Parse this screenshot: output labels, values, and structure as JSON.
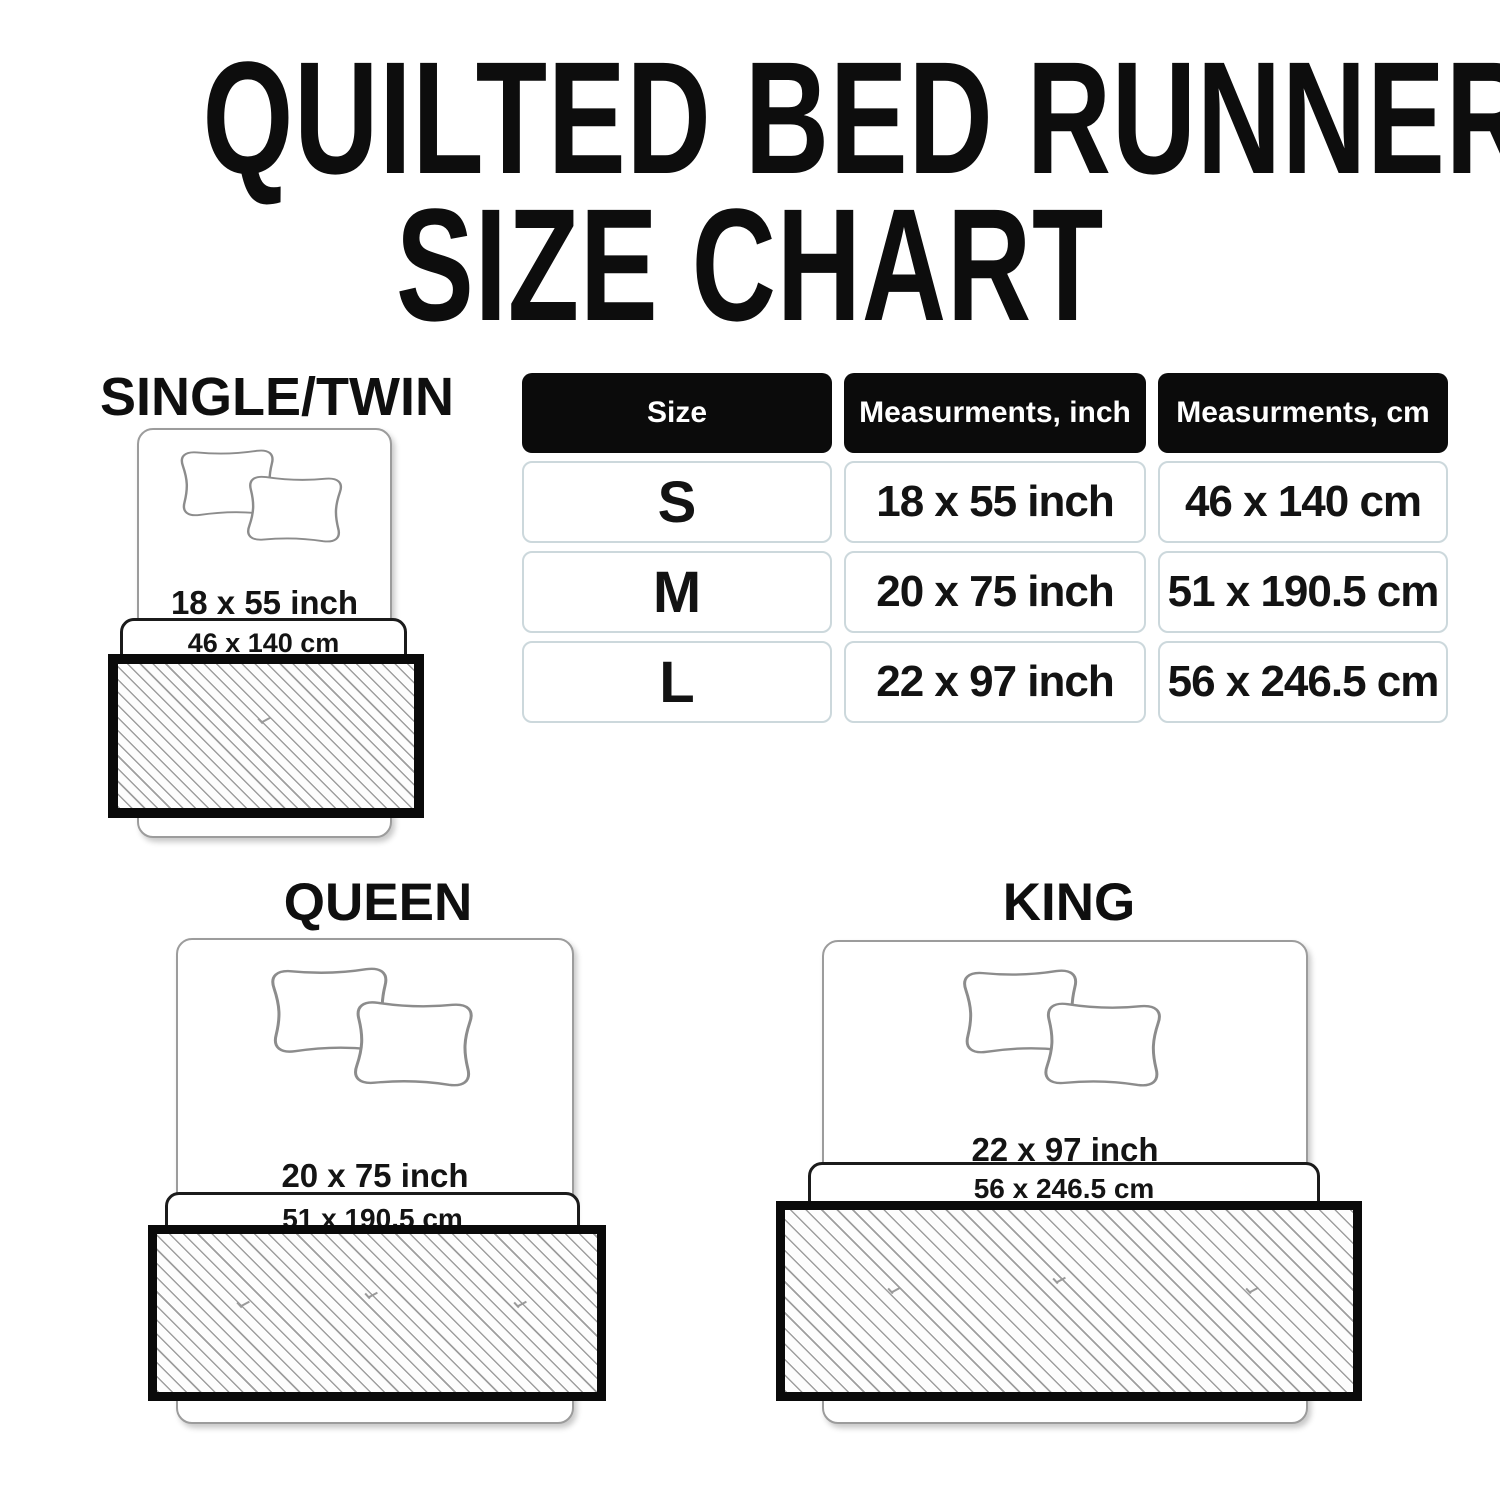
{
  "title": {
    "line1": "QUILTED BED RUNNER",
    "line2": "SIZE CHART"
  },
  "table": {
    "headers": [
      "Size",
      "Measurments, inch",
      "Measurments, cm"
    ],
    "rows": [
      {
        "size": "S",
        "inch": "18 x 55 inch",
        "cm": "46 x 140 cm"
      },
      {
        "size": "M",
        "inch": "20 x 75 inch",
        "cm": "51 x 190.5 cm"
      },
      {
        "size": "L",
        "inch": "22 x 97 inch",
        "cm": "56 x 246.5 cm"
      }
    ]
  },
  "diagrams": [
    {
      "label": "SINGLE/TWIN",
      "inch": "18 x 55 inch",
      "cm": "46 x 140 cm"
    },
    {
      "label": "QUEEN",
      "inch": "20 x 75 inch",
      "cm": "51 x 190.5 cm"
    },
    {
      "label": "KING",
      "inch": "22 x 97 inch",
      "cm": "56 x 246.5 cm"
    }
  ],
  "chart_data": {
    "type": "table",
    "title": "QUILTED BED RUNNER SIZE CHART",
    "columns": [
      "Size",
      "Measurments, inch",
      "Measurments, cm"
    ],
    "rows": [
      [
        "S",
        "18 x 55 inch",
        "46 x 140 cm"
      ],
      [
        "M",
        "20 x 75 inch",
        "51 x 190.5 cm"
      ],
      [
        "L",
        "22 x 97 inch",
        "56 x 246.5 cm"
      ]
    ]
  },
  "colors": {
    "header_bg": "#0b0b0b",
    "header_text": "#ffffff",
    "cell_border": "#ccd8dc",
    "text": "#141414",
    "runner_border": "#0a0a0a",
    "hatch_line": "#9e9e9e",
    "bed_outline": "#9c9c9c",
    "band_border": "#1b1b1b",
    "pillow_outline": "#8c8c8c"
  }
}
